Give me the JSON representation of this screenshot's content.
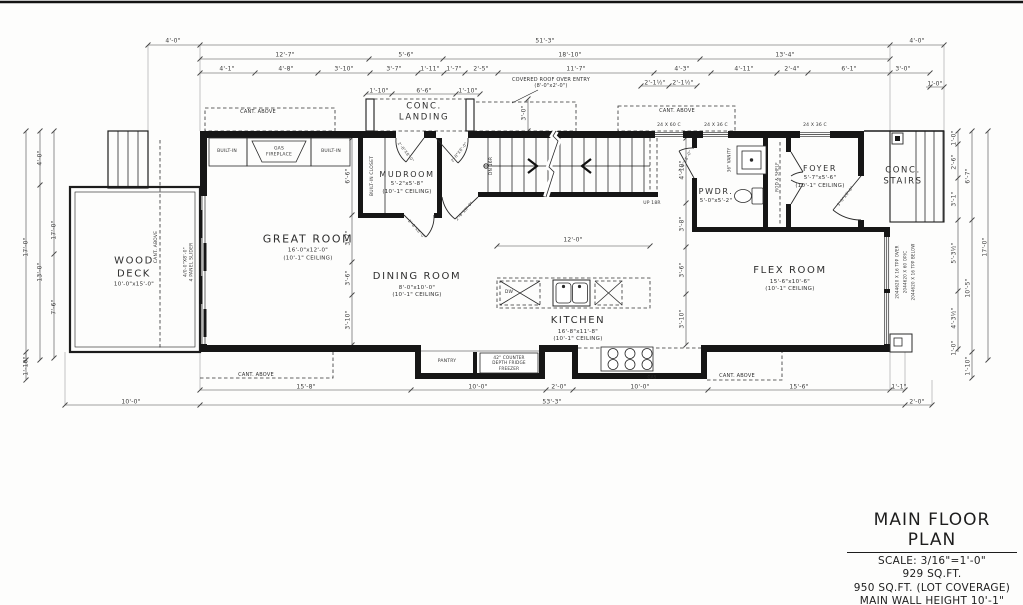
{
  "sheet": {
    "title": "MAIN FLOOR PLAN",
    "scale": "SCALE: 3/16\"=1'-0\"",
    "area": "929 SQ.FT.",
    "lot_coverage": "950 SQ.FT. (LOT COVERAGE)",
    "wall_height": "MAIN WALL HEIGHT 10'-1\""
  },
  "rooms": [
    {
      "id": "great-room",
      "name": "GREAT ROOM",
      "size": "16'-0\"x12'-0\"",
      "ceiling": "(10'-1\" CEILING)",
      "x": 308,
      "y": 247,
      "fs": 11
    },
    {
      "id": "dining-room",
      "name": "DINING ROOM",
      "size": "8'-0\"x10'-0\"",
      "ceiling": "(10'-1\" CEILING)",
      "x": 417,
      "y": 285,
      "fs": 10
    },
    {
      "id": "kitchen",
      "name": "KITCHEN",
      "size": "16'-8\"x11'-8\"",
      "ceiling": "(10'-1\" CEILING)",
      "x": 578,
      "y": 329,
      "fs": 10
    },
    {
      "id": "mudroom",
      "name": "MUDROOM",
      "size": "5'-2\"x5'-8\"",
      "ceiling": "(10'-1\" CEILING)",
      "x": 407,
      "y": 183,
      "fs": 8
    },
    {
      "id": "pwdr",
      "name": "PWDR.",
      "size": "5'-0\"x5'-2\"",
      "ceiling": "",
      "x": 716,
      "y": 196,
      "fs": 8
    },
    {
      "id": "foyer",
      "name": "FOYER",
      "size": "5'-7\"x5'-6\"",
      "ceiling": "(10'-1\" CEILING)",
      "x": 820,
      "y": 177,
      "fs": 8
    },
    {
      "id": "flex-room",
      "name": "FLEX ROOM",
      "size": "15'-6\"x10'-6\"",
      "ceiling": "(10'-1\" CEILING)",
      "x": 790,
      "y": 279,
      "fs": 10
    },
    {
      "id": "wood-deck",
      "name": "WOOD\nDECK",
      "size": "10'-0\"x15'-0\"",
      "ceiling": "",
      "x": 134,
      "y": 272,
      "fs": 10
    },
    {
      "id": "conc-landing",
      "name": "CONC.\nLANDING",
      "size": "",
      "ceiling": "",
      "x": 424,
      "y": 112,
      "fs": 8.5
    },
    {
      "id": "conc-stairs",
      "name": "CONC.\nSTAIRS",
      "size": "",
      "ceiling": "",
      "x": 903,
      "y": 176,
      "fs": 8.5
    }
  ],
  "annotations": [
    {
      "t": "BUILT-IN",
      "x": 227,
      "y": 152,
      "fs": 4.5
    },
    {
      "t": "GAS\nFIREPLACE",
      "x": 279,
      "y": 152,
      "fs": 4.5
    },
    {
      "t": "BUILT-IN",
      "x": 331,
      "y": 152,
      "fs": 4.5
    },
    {
      "t": "BUILT-IN CLOSET",
      "x": 373,
      "y": 176,
      "fs": 4.5,
      "r": -90
    },
    {
      "t": "CANT. ABOVE",
      "x": 258,
      "y": 112,
      "fs": 5
    },
    {
      "t": "CANT. ABOVE",
      "x": 677,
      "y": 111,
      "fs": 5
    },
    {
      "t": "CANT. ABOVE",
      "x": 157,
      "y": 247,
      "fs": 4.5,
      "r": -90
    },
    {
      "t": "CANT. ABOVE",
      "x": 256,
      "y": 375,
      "fs": 5
    },
    {
      "t": "CANT. ABOVE",
      "x": 737,
      "y": 376,
      "fs": 5
    },
    {
      "t": "COVERED ROOF OVER ENTRY\n(8'-0\"x2'-0\")",
      "x": 551,
      "y": 83,
      "fs": 5
    },
    {
      "t": "4/0-0\"X8'-0\"\n4 PANEL SLIDER",
      "x": 189,
      "y": 262,
      "fs": 4.5,
      "r": -90
    },
    {
      "t": "DN 16R",
      "x": 492,
      "y": 166,
      "fs": 4.5,
      "r": -90
    },
    {
      "t": "UP 18R",
      "x": 652,
      "y": 204,
      "fs": 4.5
    },
    {
      "t": "PANTRY",
      "x": 447,
      "y": 362,
      "fs": 4.5
    },
    {
      "t": "42\" COUNTER\nDEPTH FRIDGE\nFREEZER",
      "x": 509,
      "y": 363,
      "fs": 4.2
    },
    {
      "t": "36\" VANITY",
      "x": 729,
      "y": 160,
      "fs": 4,
      "r": -90
    },
    {
      "t": "ROD & SHELF",
      "x": 777,
      "y": 177,
      "fs": 4,
      "r": -90
    },
    {
      "t": "DW",
      "x": 509,
      "y": 293,
      "fs": 4.5
    },
    {
      "t": "GAS",
      "x": 652,
      "y": 377,
      "fs": 4
    },
    {
      "t": "24 X 60 C",
      "x": 669,
      "y": 126,
      "fs": 4.5
    },
    {
      "t": "24 X 36 C",
      "x": 716,
      "y": 126,
      "fs": 4.5
    },
    {
      "t": "24 X 36 C",
      "x": 815,
      "y": 126,
      "fs": 4.5
    },
    {
      "t": "2044620 X 16 TPP OVER",
      "x": 897,
      "y": 272,
      "fs": 4,
      "r": -90
    },
    {
      "t": "2044620 X 60 OP/C",
      "x": 905,
      "y": 272,
      "fs": 4,
      "r": -90
    },
    {
      "t": "2044620 X 16 TPP BELOW",
      "x": 913,
      "y": 272,
      "fs": 4,
      "r": -90
    }
  ],
  "door_labels": [
    {
      "t": "2'-8\"X8'-0\"",
      "x": 406,
      "y": 152,
      "r": 52
    },
    {
      "t": "2'-8\"X8'-0\"",
      "x": 459,
      "y": 152,
      "r": -52
    },
    {
      "t": "2'-8\"X8'-0\"",
      "x": 417,
      "y": 229,
      "r": 48
    },
    {
      "t": "2'-8\"X8'-0\"",
      "x": 464,
      "y": 211,
      "r": -48
    },
    {
      "t": "2'-6\"X8'-0\"",
      "x": 685,
      "y": 161,
      "r": -62
    },
    {
      "t": "3'-0\"X8'-0\"",
      "x": 845,
      "y": 196,
      "r": -52
    }
  ],
  "dim_labels": [
    {
      "t": "4'-0\"",
      "x": 173,
      "y": 41
    },
    {
      "t": "51'-3\"",
      "x": 545,
      "y": 41
    },
    {
      "t": "4'-0\"",
      "x": 917,
      "y": 41
    },
    {
      "t": "12'-7\"",
      "x": 285,
      "y": 55
    },
    {
      "t": "5'-6\"",
      "x": 406,
      "y": 55
    },
    {
      "t": "18'-10\"",
      "x": 570,
      "y": 55
    },
    {
      "t": "13'-4\"",
      "x": 785,
      "y": 55
    },
    {
      "t": "4'-1\"",
      "x": 227,
      "y": 69
    },
    {
      "t": "4'-8\"",
      "x": 286,
      "y": 69
    },
    {
      "t": "3'-10\"",
      "x": 344,
      "y": 69
    },
    {
      "t": "3'-7\"",
      "x": 394,
      "y": 69
    },
    {
      "t": "1'-11\"",
      "x": 430,
      "y": 69
    },
    {
      "t": "1'-7\"",
      "x": 454,
      "y": 69
    },
    {
      "t": "2'-5\"",
      "x": 481,
      "y": 69
    },
    {
      "t": "11'-7\"",
      "x": 576,
      "y": 69
    },
    {
      "t": "4'-3\"",
      "x": 682,
      "y": 69
    },
    {
      "t": "4'-11\"",
      "x": 744,
      "y": 69
    },
    {
      "t": "2'-4\"",
      "x": 792,
      "y": 69
    },
    {
      "t": "6'-1\"",
      "x": 849,
      "y": 69
    },
    {
      "t": "3'-0\"",
      "x": 903,
      "y": 69
    },
    {
      "t": "2'-1½\"",
      "x": 655,
      "y": 83
    },
    {
      "t": "2'-1½\"",
      "x": 683,
      "y": 83
    },
    {
      "t": "1'-0\"",
      "x": 935,
      "y": 84
    },
    {
      "t": "1'-10\"",
      "x": 379,
      "y": 91
    },
    {
      "t": "6'-6\"",
      "x": 424,
      "y": 91
    },
    {
      "t": "1'-10\"",
      "x": 468,
      "y": 91
    },
    {
      "t": "3'-0\"",
      "x": 524,
      "y": 113,
      "r": -90
    },
    {
      "t": "17'-0\"",
      "x": 26,
      "y": 247,
      "r": -90
    },
    {
      "t": "4'-0\"",
      "x": 40,
      "y": 158,
      "r": -90
    },
    {
      "t": "13'-0\"",
      "x": 40,
      "y": 272,
      "r": -90
    },
    {
      "t": "17'-0\"",
      "x": 54,
      "y": 230,
      "r": -90
    },
    {
      "t": "7'-6\"",
      "x": 54,
      "y": 307,
      "r": -90
    },
    {
      "t": "1'-10\"",
      "x": 26,
      "y": 366,
      "r": -90
    },
    {
      "t": "6'-6\"",
      "x": 348,
      "y": 176,
      "r": -90
    },
    {
      "t": "3'-7\"",
      "x": 348,
      "y": 238,
      "r": -90
    },
    {
      "t": "3'-6\"",
      "x": 348,
      "y": 278,
      "r": -90
    },
    {
      "t": "3'-10\"",
      "x": 348,
      "y": 320,
      "r": -90
    },
    {
      "t": "4'-10\"",
      "x": 682,
      "y": 170,
      "r": -90
    },
    {
      "t": "3'-8\"",
      "x": 682,
      "y": 224,
      "r": -90
    },
    {
      "t": "3'-6\"",
      "x": 682,
      "y": 270,
      "r": -90
    },
    {
      "t": "3'-10\"",
      "x": 682,
      "y": 319,
      "r": -90
    },
    {
      "t": "12'-0\"",
      "x": 573,
      "y": 240
    },
    {
      "t": "1'-0\"",
      "x": 954,
      "y": 138,
      "r": -90
    },
    {
      "t": "2'-6\"",
      "x": 954,
      "y": 162,
      "r": -90
    },
    {
      "t": "3'-1\"",
      "x": 954,
      "y": 199,
      "r": -90
    },
    {
      "t": "5'-3½\"",
      "x": 954,
      "y": 253,
      "r": -90
    },
    {
      "t": "4'-3½\"",
      "x": 954,
      "y": 318,
      "r": -90
    },
    {
      "t": "1'-0\"",
      "x": 954,
      "y": 348,
      "r": -90
    },
    {
      "t": "6'-7\"",
      "x": 968,
      "y": 176,
      "r": -90
    },
    {
      "t": "10'-5\"",
      "x": 968,
      "y": 288,
      "r": -90
    },
    {
      "t": "1'-10\"",
      "x": 968,
      "y": 366,
      "r": -90
    },
    {
      "t": "17'-0\"",
      "x": 985,
      "y": 247,
      "r": -90
    },
    {
      "t": "15'-8\"",
      "x": 306,
      "y": 387
    },
    {
      "t": "10'-0\"",
      "x": 478,
      "y": 387
    },
    {
      "t": "2'-0\"",
      "x": 559,
      "y": 387
    },
    {
      "t": "10'-0\"",
      "x": 640,
      "y": 387
    },
    {
      "t": "15'-6\"",
      "x": 799,
      "y": 387
    },
    {
      "t": "1'-1\"",
      "x": 899,
      "y": 387
    },
    {
      "t": "10'-0\"",
      "x": 131,
      "y": 402
    },
    {
      "t": "53'-3\"",
      "x": 552,
      "y": 402
    },
    {
      "t": "2'-0\"",
      "x": 917,
      "y": 402
    }
  ]
}
